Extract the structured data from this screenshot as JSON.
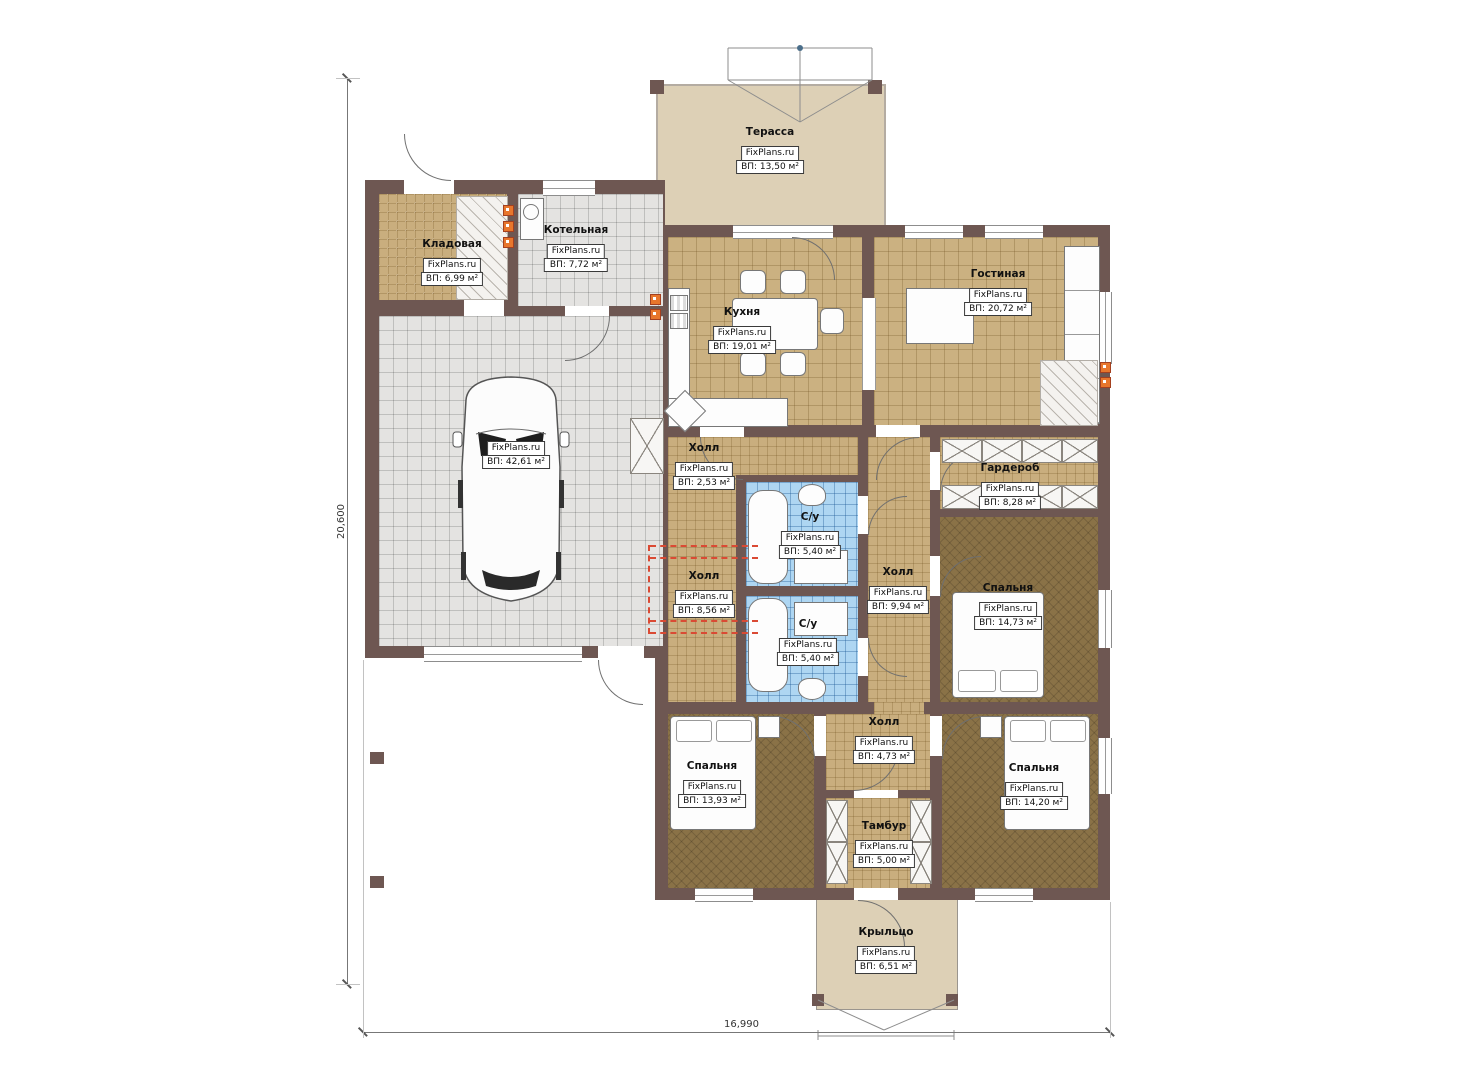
{
  "brand": "FixPlans.ru",
  "dimensions": {
    "horizontal_total": "16,990",
    "vertical_total": "20,600"
  },
  "rooms": {
    "terrace": {
      "title": "Терасса",
      "brand": "FixPlans.ru",
      "area": "ВП: 13,50 м²"
    },
    "storage": {
      "title": "Кладовая",
      "brand": "FixPlans.ru",
      "area": "ВП: 6,99 м²"
    },
    "boiler": {
      "title": "Котельная",
      "brand": "FixPlans.ru",
      "area": "ВП: 7,72 м²"
    },
    "kitchen": {
      "title": "Кухня",
      "brand": "FixPlans.ru",
      "area": "ВП: 19,01 м²"
    },
    "living": {
      "title": "Гостиная",
      "brand": "FixPlans.ru",
      "area": "ВП: 20,72 м²"
    },
    "garage": {
      "title": "Гараж",
      "brand": "FixPlans.ru",
      "area": "ВП: 42,61 м²"
    },
    "hall_small": {
      "title": "Холл",
      "brand": "FixPlans.ru",
      "area": "ВП: 2,53 м²"
    },
    "wardrobe": {
      "title": "Гардероб",
      "brand": "FixPlans.ru",
      "area": "ВП: 8,28 м²"
    },
    "bath_top": {
      "title": "С/у",
      "brand": "FixPlans.ru",
      "area": "ВП: 5,40 м²"
    },
    "bath_bottom": {
      "title": "С/у",
      "brand": "FixPlans.ru",
      "area": "ВП: 5,40 м²"
    },
    "hall_left": {
      "title": "Холл",
      "brand": "FixPlans.ru",
      "area": "ВП: 8,56 м²"
    },
    "hall_right": {
      "title": "Холл",
      "brand": "FixPlans.ru",
      "area": "ВП: 9,94 м²"
    },
    "bedroom_right": {
      "title": "Спальня",
      "brand": "FixPlans.ru",
      "area": "ВП: 14,73 м²"
    },
    "hall_bottom": {
      "title": "Холл",
      "brand": "FixPlans.ru",
      "area": "ВП: 4,73 м²"
    },
    "bedroom_bl": {
      "title": "Спальня",
      "brand": "FixPlans.ru",
      "area": "ВП: 13,93 м²"
    },
    "tambour": {
      "title": "Тамбур",
      "brand": "FixPlans.ru",
      "area": "ВП: 5,00 м²"
    },
    "bedroom_br": {
      "title": "Спальня",
      "brand": "FixPlans.ru",
      "area": "ВП: 14,20 м²"
    },
    "porch": {
      "title": "Крыльцо",
      "brand": "FixPlans.ru",
      "area": "ВП: 6,51 м²"
    }
  },
  "colors": {
    "wall": "#6e5752",
    "floor_tan": "#cbb181",
    "floor_gray": "#e4e3e1",
    "floor_blue": "#aed6f2",
    "carpet_dark": "#8a7247",
    "terrace_beige": "#ddd0b6",
    "accent_red_dash": "#da4a34",
    "accent_orange": "#e8762c"
  }
}
